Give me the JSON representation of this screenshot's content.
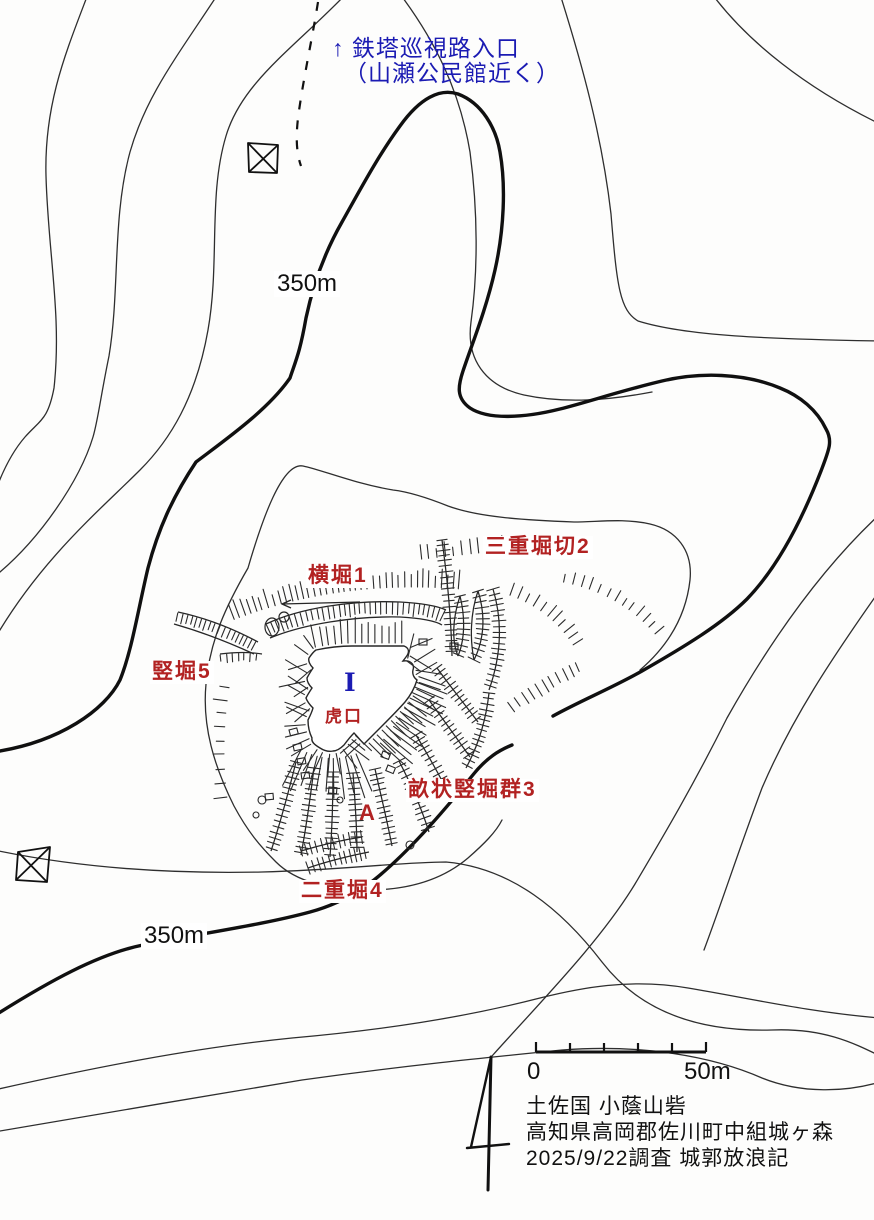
{
  "colors": {
    "red_label": "#b22222",
    "blue_label": "#1b1bb3",
    "ink": "#1a1a1a"
  },
  "entrance_note": {
    "line1": "↑ 鉄塔巡視路入口",
    "line2": "（山瀬公民館近く）"
  },
  "contour_labels": {
    "upper": "350m",
    "lower": "350m"
  },
  "features": {
    "yokobori1": "横堀1",
    "sanju_horikiri2": "三重堀切2",
    "tatebori5": "竪堀5",
    "koguchi": "虎口",
    "kuruwa_I": "I",
    "unejo_tatebori_gun3": "畝状竪堀群3",
    "point_A": "A",
    "nijubori4": "二重堀4"
  },
  "scale_bar": {
    "start_label": "0",
    "end_label": "50m"
  },
  "credits": {
    "line1": "土佐国 小蔭山砦",
    "line2": "高知県高岡郡佐川町中組城ヶ森",
    "line3": "2025/9/22調査 城郭放浪記"
  }
}
